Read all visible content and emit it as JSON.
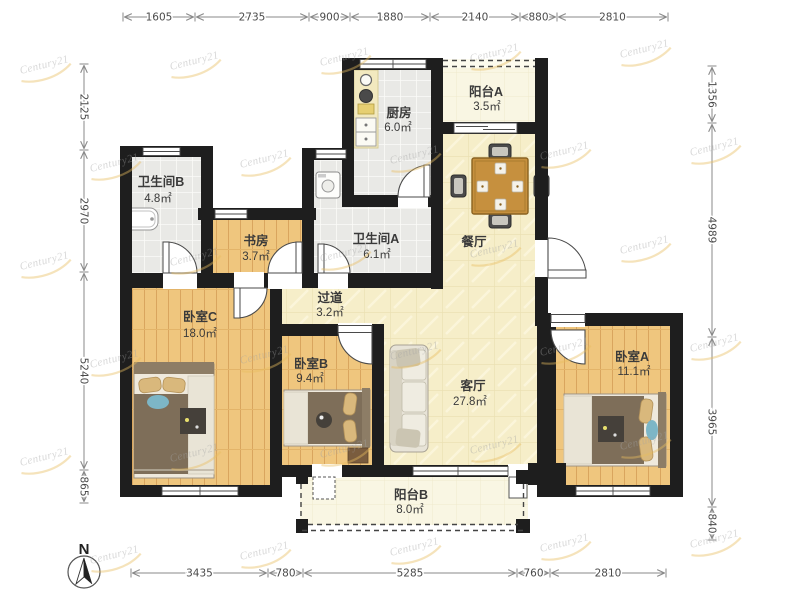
{
  "watermark": {
    "text": "Century21",
    "text_color": "#a3a3a3",
    "swoosh_color": "#e9bd5f"
  },
  "north": {
    "label": "N"
  },
  "rooms": [
    {
      "name": "卫生间B",
      "area": "4.8㎡"
    },
    {
      "name": "厨房",
      "area": "6.0㎡"
    },
    {
      "name": "阳台A",
      "area": "3.5㎡"
    },
    {
      "name": "书房",
      "area": "3.7㎡"
    },
    {
      "name": "卫生间A",
      "area": "6.1㎡"
    },
    {
      "name": "餐厅",
      "area": ""
    },
    {
      "name": "过道",
      "area": "3.2㎡"
    },
    {
      "name": "卧室C",
      "area": "18.0㎡"
    },
    {
      "name": "卧室B",
      "area": "9.4㎡"
    },
    {
      "name": "客厅",
      "area": "27.8㎡"
    },
    {
      "name": "卧室A",
      "area": "11.1㎡"
    },
    {
      "name": "阳台B",
      "area": "8.0㎡"
    }
  ],
  "dimensions": {
    "top": [
      "1605",
      "2735",
      "900",
      "1880",
      "2140",
      "880",
      "2810"
    ],
    "bottom": [
      "3435",
      "780",
      "5285",
      "760",
      "2810"
    ],
    "left": [
      "2125",
      "2970",
      "5240",
      "865"
    ],
    "right": [
      "1356",
      "4989",
      "3965",
      "840"
    ]
  },
  "colors": {
    "wall": "#1e1e1e",
    "wood_floor": "#efc67e",
    "tile_floor": "#e9e9e6",
    "marble_floor": "#f6eec9",
    "balcony_floor": "#f9f6e3",
    "table_wood": "#c6903e"
  }
}
